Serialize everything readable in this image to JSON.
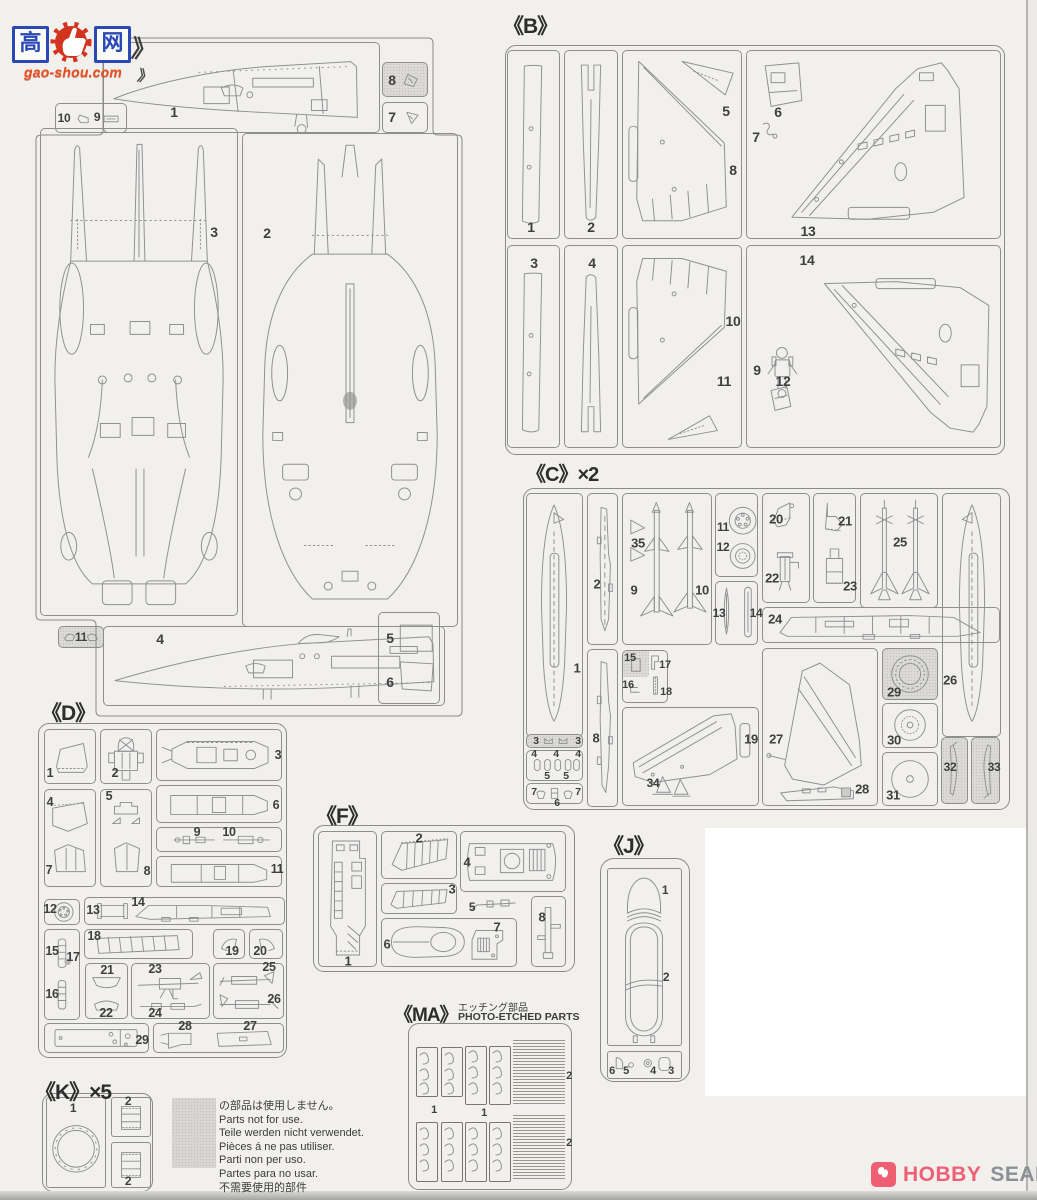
{
  "watermark": {
    "char_left": "高",
    "char_right": "网",
    "domain": "gao-shou.com",
    "chevron": "》"
  },
  "brand": {
    "hobby": "HOBBY",
    "search": "SEARCH"
  },
  "notice": {
    "lines": [
      "の部品は使用しません。",
      "Parts not for use.",
      "Teile werden nicht verwendet.",
      "Pièces á ne pas utiliser.",
      "Parti non per uso.",
      "Partes para no usar.",
      "不需要使用的部件"
    ]
  },
  "sprues": {
    "a": {
      "parts": {
        "p1": "1",
        "p2": "2",
        "p3": "3",
        "p4": "4",
        "p5": "5",
        "p6": "6",
        "p7": "7",
        "p8": "8",
        "p9": "9",
        "p10": "10",
        "p11": "11"
      }
    },
    "b": {
      "label": "《B》",
      "parts": {
        "p1": "1",
        "p2": "2",
        "p3": "3",
        "p4": "4",
        "p5": "5",
        "p6": "6",
        "p7": "7",
        "p8": "8",
        "p9": "9",
        "p10": "10",
        "p11": "11",
        "p12": "12",
        "p13": "13",
        "p14": "14"
      }
    },
    "c": {
      "label": "《C》×2",
      "parts": {
        "p1": "1",
        "p2": "2",
        "p3": "3",
        "p4": "4",
        "p5": "5",
        "p6": "6",
        "p7": "7",
        "p8": "8",
        "p9": "9",
        "p10": "10",
        "p11": "11",
        "p12": "12",
        "p13": "13",
        "p14": "14",
        "p15": "15",
        "p16": "16",
        "p17": "17",
        "p18": "18",
        "p19": "19",
        "p20": "20",
        "p21": "21",
        "p22": "22",
        "p23": "23",
        "p24": "24",
        "p25": "25",
        "p26": "26",
        "p27": "27",
        "p28": "28",
        "p29": "29",
        "p30": "30",
        "p31": "31",
        "p32": "32",
        "p33": "33",
        "p34": "34",
        "p35": "35"
      }
    },
    "d": {
      "label": "《D》",
      "parts": {
        "p1": "1",
        "p2": "2",
        "p3": "3",
        "p4": "4",
        "p5": "5",
        "p6": "6",
        "p7": "7",
        "p8": "8",
        "p9": "9",
        "p10": "10",
        "p11": "11",
        "p12": "12",
        "p13": "13",
        "p14": "14",
        "p15": "15",
        "p16": "16",
        "p17": "17",
        "p18": "18",
        "p19": "19",
        "p20": "20",
        "p21": "21",
        "p22": "22",
        "p23": "23",
        "p24": "24",
        "p25": "25",
        "p26": "26",
        "p27": "27",
        "p28": "28",
        "p29": "29"
      }
    },
    "f": {
      "label": "《F》",
      "parts": {
        "p1": "1",
        "p2": "2",
        "p3": "3",
        "p4": "4",
        "p5": "5",
        "p6": "6",
        "p7": "7",
        "p8": "8"
      }
    },
    "j": {
      "label": "《J》",
      "parts": {
        "p1": "1",
        "p2": "2",
        "p3": "3",
        "p4": "4",
        "p5": "5",
        "p6": "6"
      }
    },
    "k": {
      "label": "《K》×5",
      "parts": {
        "p1": "1",
        "p2": "2"
      }
    },
    "ma": {
      "label": "《MA》",
      "subtitle_jp": "エッチング部品",
      "subtitle_en": "PHOTO-ETCHED PARTS",
      "parts": {
        "p1": "1",
        "p2": "2"
      }
    }
  }
}
